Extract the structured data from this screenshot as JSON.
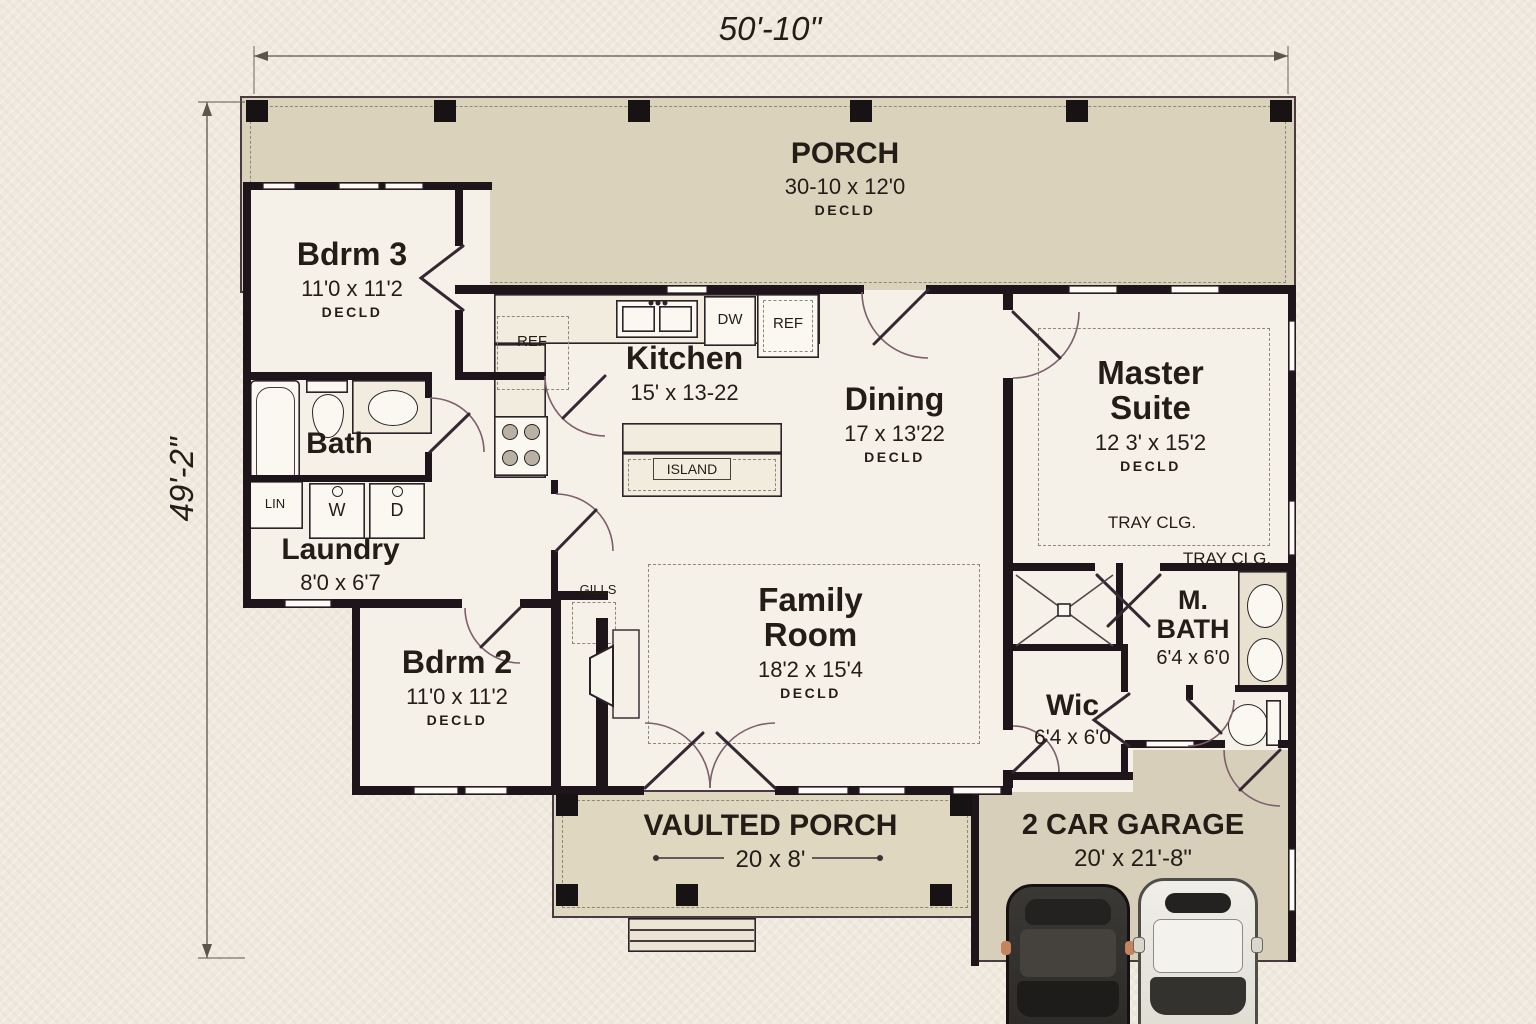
{
  "dims": {
    "top": "50'-10\"",
    "left": "49'-2\""
  },
  "rooms": {
    "porch": {
      "name": "PORCH",
      "size": "30-10 x 12'0",
      "note": "DECLD"
    },
    "bdrm3": {
      "name": "Bdrm 3",
      "size": "11'0 x 11'2",
      "note": "DECLD"
    },
    "bath": {
      "name": "Bath"
    },
    "laundry": {
      "name": "Laundry",
      "size": "8'0 x 6'7"
    },
    "bdrm2": {
      "name": "Bdrm 2",
      "size": "11'0 x 11'2",
      "note": "DECLD"
    },
    "kitchen": {
      "name": "Kitchen",
      "size": "15' x 13-22"
    },
    "dining": {
      "name": "Dining",
      "size": "17 x 13'22",
      "note": "DECLD"
    },
    "master": {
      "name": "Master Suite",
      "size": "12 3' x 15'2",
      "note": "DECLD"
    },
    "family": {
      "name": "Family Room",
      "size": "18'2 x 15'4",
      "note": "DECLD"
    },
    "mbath": {
      "name": "M. BATH",
      "size": "6'4 x 6'0"
    },
    "wic": {
      "name": "Wic",
      "size": "6'4 x 6'0"
    },
    "vporch": {
      "name": "VAULTED PORCH",
      "size": "20 x 8'"
    },
    "garage": {
      "name": "2 CAR GARAGE",
      "size": "20' x 21'-8\""
    }
  },
  "fixtures": {
    "tray_clg": "TRAY CLG.",
    "ref_pantry": "REF",
    "dw": "DW",
    "ref": "REF",
    "island": "ISLAND",
    "lin": "LIN",
    "washer": "W",
    "dryer": "D",
    "gills": "GILLS"
  },
  "colors": {
    "paper": "#efe9de",
    "porch_tan": "#dbd2bc",
    "ink": "#241c16",
    "wall": "#1e151a"
  }
}
